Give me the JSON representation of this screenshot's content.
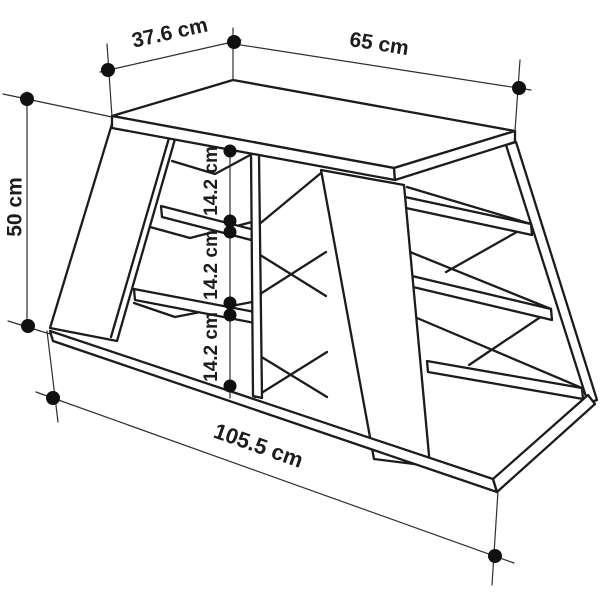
{
  "diagram": {
    "kind": "furniture-dimension-drawing",
    "subject": "trapezoid shelving unit line drawing with dimension annotations",
    "dimensions": {
      "top_depth": "37.6 cm",
      "top_width": "65 cm",
      "side_height": "50 cm",
      "shelf_gaps": [
        "14.2 cm",
        "14.2 cm",
        "14.2 cm"
      ],
      "bottom_width": "105.5 cm"
    },
    "colors": {
      "structure_line": "#1c1c1c",
      "dimension_line": "#2e2e2e",
      "dot": "#101010",
      "background": "#ffffff"
    }
  }
}
